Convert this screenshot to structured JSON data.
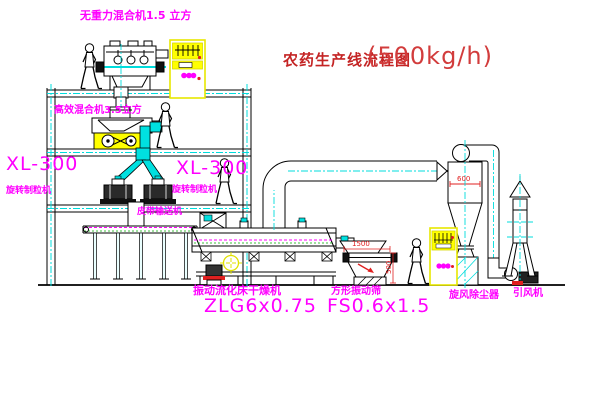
{
  "title": {
    "zh": "农药生产线流程图",
    "capacity": "(500kg/h)"
  },
  "labels": {
    "gravity_mixer": "无重力混合机1.5 立方",
    "high_efficiency_mixer": "高效混合机3.5立方",
    "granulator_model_left": "XL-300",
    "granulator_name_left": "旋转制粒机",
    "granulator_model_right": "XL-300",
    "granulator_name_right": "旋转制粒机",
    "belt_conveyor": "皮带输送机",
    "dryer_name": "振动流化床干燥机",
    "dryer_model": "ZLG6x0.75",
    "sieve_name": "方形振动筛",
    "sieve_model": "FS0.6x1.5",
    "cyclone_name": "旋风除尘器",
    "fan_name": "引风机"
  },
  "dimensions": {
    "sieve_width": "1500",
    "sieve_height": "500",
    "cyclone_diameter": "600"
  },
  "colors": {
    "label_magenta": "#ff00ff",
    "title_red": "#c42424",
    "dimension_red": "#e02020",
    "highlight_yellow": "#ffff00",
    "centerline_cyan": "#00e0e0",
    "line_black": "#000000"
  }
}
